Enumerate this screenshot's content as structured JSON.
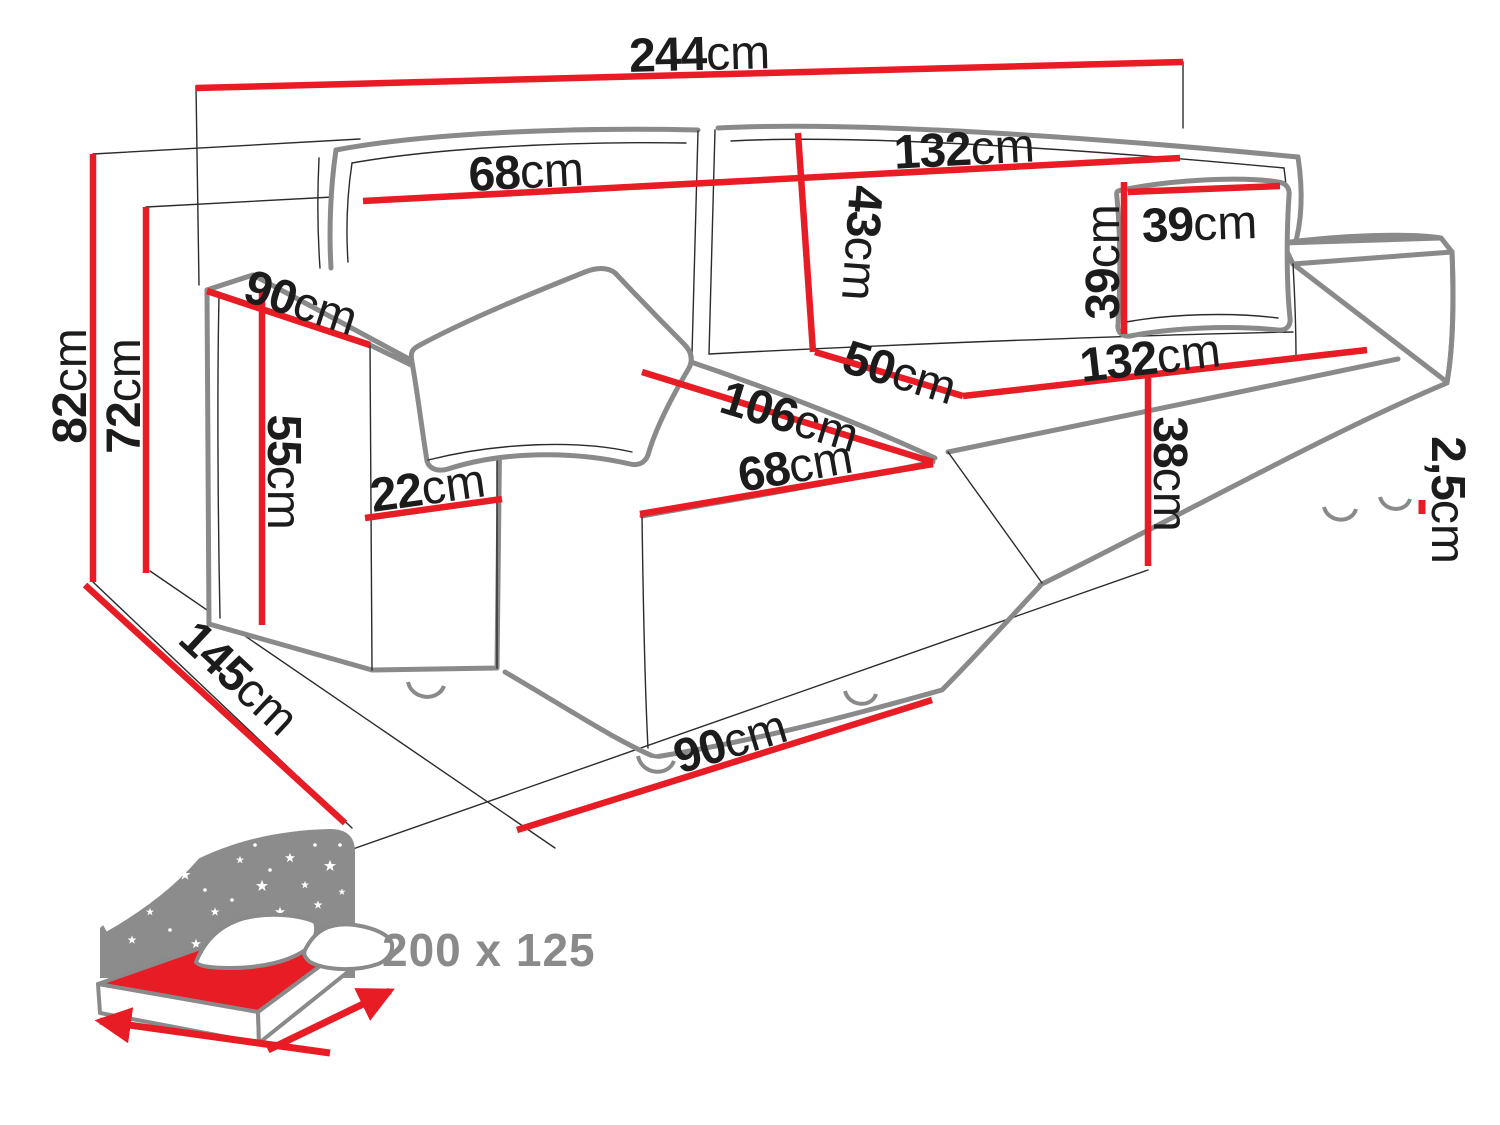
{
  "colors": {
    "dimension_red": "#e81c24",
    "text_black": "#1c1c1c",
    "sofa_outline_gray": "#8a8a8a",
    "icon_gray": "#8c8c8c"
  },
  "diagram": {
    "dimensions": [
      {
        "id": "total-width",
        "value": "244",
        "unit": "cm"
      },
      {
        "id": "backrest-left-width",
        "value": "68",
        "unit": "cm"
      },
      {
        "id": "backrest-right-width",
        "value": "132",
        "unit": "cm"
      },
      {
        "id": "backrest-height",
        "value": "43",
        "unit": "cm"
      },
      {
        "id": "seat-depth",
        "value": "50",
        "unit": "cm"
      },
      {
        "id": "seat-width",
        "value": "132",
        "unit": "cm"
      },
      {
        "id": "chaise-length",
        "value": "106",
        "unit": "cm"
      },
      {
        "id": "chaise-width",
        "value": "68",
        "unit": "cm"
      },
      {
        "id": "pillow-width",
        "value": "39",
        "unit": "cm"
      },
      {
        "id": "pillow-height",
        "value": "39",
        "unit": "cm"
      },
      {
        "id": "total-height",
        "value": "82",
        "unit": "cm"
      },
      {
        "id": "back-height",
        "value": "72",
        "unit": "cm"
      },
      {
        "id": "armrest-depth",
        "value": "90",
        "unit": "cm"
      },
      {
        "id": "armrest-height",
        "value": "55",
        "unit": "cm"
      },
      {
        "id": "armrest-width",
        "value": "22",
        "unit": "cm"
      },
      {
        "id": "seat-height",
        "value": "38",
        "unit": "cm"
      },
      {
        "id": "leg-height",
        "value": "2,5",
        "unit": "cm"
      },
      {
        "id": "total-depth",
        "value": "145",
        "unit": "cm"
      },
      {
        "id": "chaise-floor-width",
        "value": "90",
        "unit": "cm"
      }
    ],
    "sleeping_area": {
      "value": "200 x 125"
    }
  }
}
